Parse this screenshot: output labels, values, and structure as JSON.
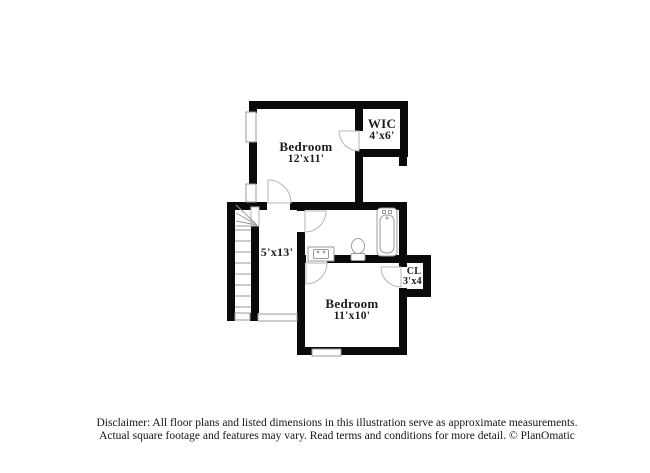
{
  "rooms": {
    "bedroom_upper": {
      "name": "Bedroom",
      "dims": "12'x11'"
    },
    "wic": {
      "name": "WIC",
      "dims": "4'x6'"
    },
    "hallway": {
      "name": "",
      "dims": "5'x13'"
    },
    "bedroom_lower": {
      "name": "Bedroom",
      "dims": "11'x10'"
    },
    "closet": {
      "name": "CL",
      "dims": "3'x4'"
    }
  },
  "fixtures": [
    "bathtub",
    "toilet",
    "sink-vanity",
    "stairs"
  ],
  "disclaimer": {
    "line1": "Disclaimer: All floor plans and listed dimensions in this illustration serve as approximate measurements.",
    "line2": "Actual square footage and features may vary. Read terms and conditions for more detail. © PlanOmatic"
  },
  "colors": {
    "wall": "#0a0a0a",
    "fixture": "#9b9b9b",
    "text": "#1c1c1c"
  }
}
